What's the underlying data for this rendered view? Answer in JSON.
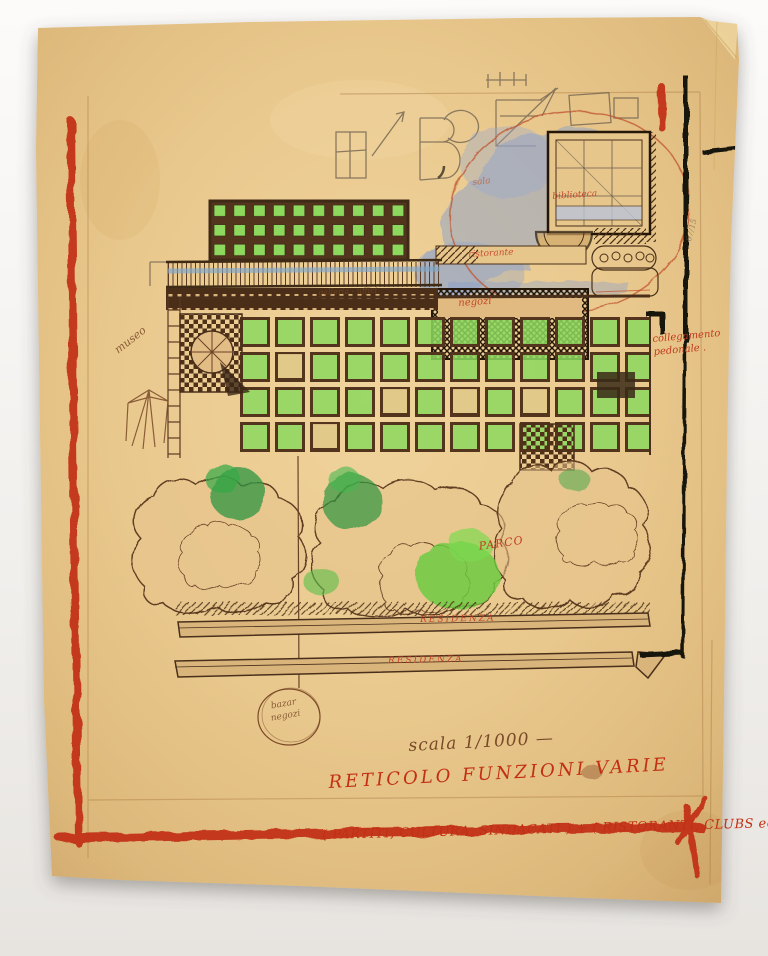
{
  "artwork": {
    "kind": "hand-drawn urban plan sketch on yellowed tracing paper"
  },
  "labels": {
    "museo": "museo",
    "galleria": "galleria - uffici",
    "sala": "sala",
    "biblioteca": "biblioteca",
    "ristorante": "ristorante",
    "negozi": "negozi",
    "collegamento_pedonale": "collegamento pedonale .",
    "parco": "PARCO",
    "residenza_upper": "RESIDENZA",
    "residenza_lower": "RESIDENZA",
    "bazar_line1": "bazar",
    "bazar_line2": "negozi",
    "scala": "scala 1/1000 —",
    "titolo": "RETICOLO FUNZIONI VARIE",
    "sottotitolo": "( PARTITI, CULTURA, SINDACATI ) + ( RISTORANTI, CLUBS ecc. )",
    "nota_margine": "67/15"
  },
  "colors": {
    "paper": "#e9c88d",
    "marker_red": "#c22f12",
    "ink_sepia": "#6b4126",
    "ink_dark": "#2e2318",
    "marker_black": "#17120e",
    "green_bright": "#6fcf45",
    "green_dark": "#2f9440",
    "blue_wash": "#8aa0cc",
    "pencil": "#6a5d4d"
  }
}
